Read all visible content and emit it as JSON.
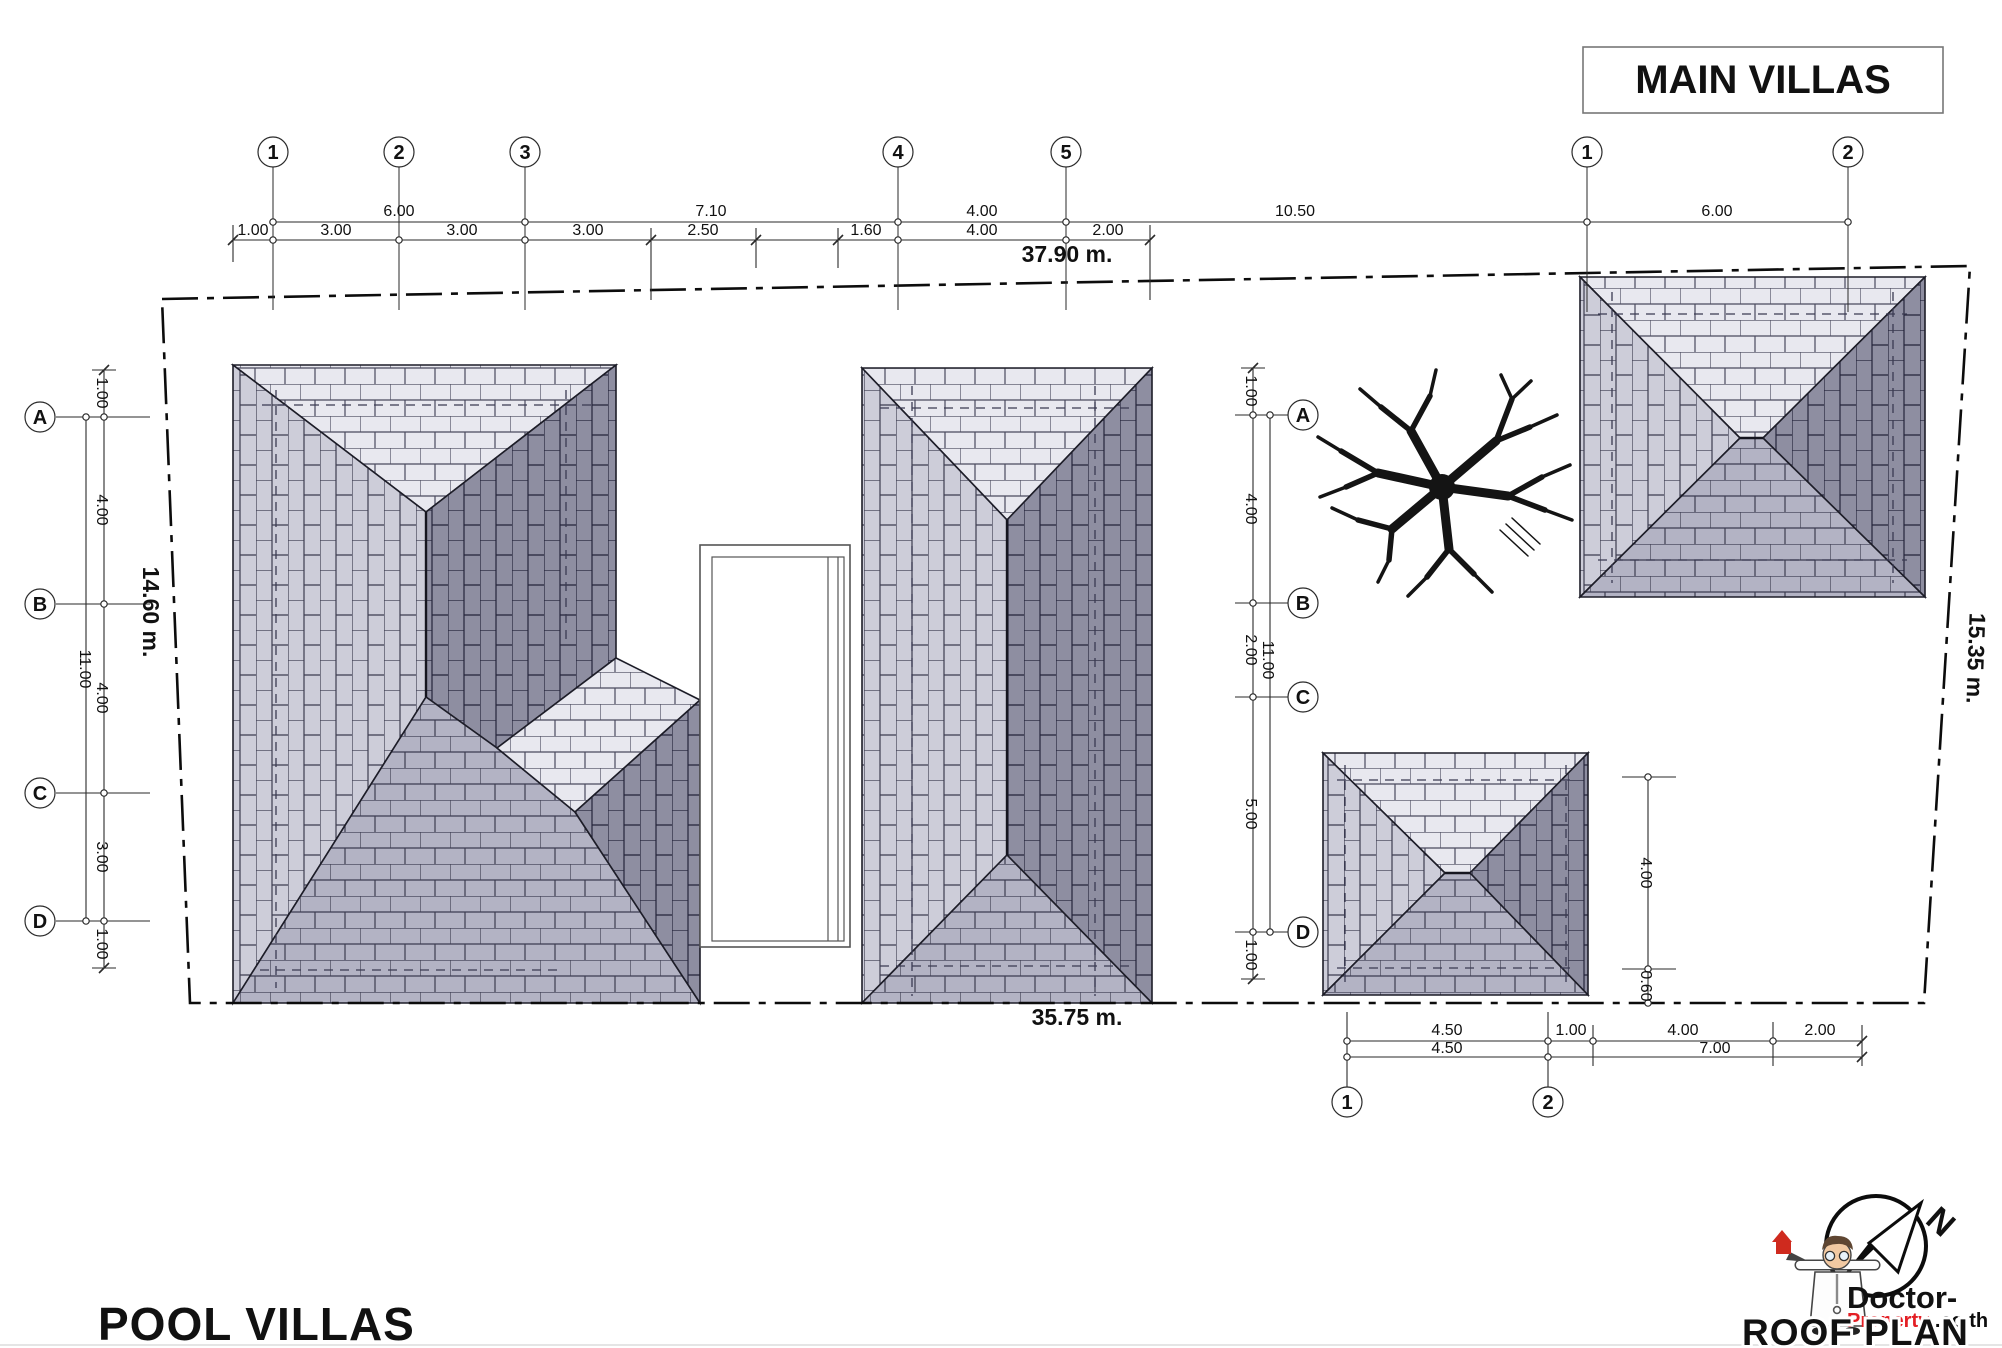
{
  "colors": {
    "accent_red": "#ee3124",
    "brand_red": "#e31e24",
    "roof_light": "#e8e8ef",
    "roof_light_mid": "#cdcdd9",
    "roof_mid": "#b3b3c4",
    "roof_dark": "#8e8ea1",
    "line": "#1a1a1a"
  },
  "header": {
    "main_villas": "MAIN VILLAS"
  },
  "titles": {
    "pool_villas": "POOL VILLAS",
    "roof_plan": "ROOF PLAN",
    "total_width": "37.90 m.",
    "bottom_width": "35.75 m.",
    "left_height": "14.60 m.",
    "right_height": "15.35 m."
  },
  "brand": {
    "line1": "Doctor-",
    "line2": "Property",
    "line2b": ".co.th",
    "north": "N"
  },
  "top_grid": {
    "bubbles": [
      "1",
      "2",
      "3",
      "4",
      "5",
      "1",
      "2"
    ]
  },
  "top_dims": {
    "upper": [
      "6.00",
      "7.10",
      "4.00",
      "10.50",
      "6.00"
    ],
    "lower": [
      "1.00",
      "3.00",
      "3.00",
      "3.00",
      "2.50",
      "1.60",
      "4.00",
      "2.00"
    ]
  },
  "left_grid": {
    "letters": [
      "A",
      "B",
      "C",
      "D"
    ],
    "dims": [
      "1.00",
      "4.00",
      "4.00",
      "3.00",
      "1.00"
    ],
    "span": "11.00"
  },
  "mid_grid": {
    "letters": [
      "A",
      "B",
      "C",
      "D"
    ],
    "dims": [
      "1.00",
      "4.00",
      "2.00",
      "5.00",
      "1.00"
    ],
    "span": "11.00"
  },
  "br_dims": {
    "row1": [
      "4.50",
      "1.00",
      "4.00",
      "2.00"
    ],
    "row2": [
      "4.50",
      "7.00"
    ],
    "vertical": [
      "4.00",
      "0.60"
    ],
    "bubbles": [
      "1",
      "2"
    ]
  }
}
